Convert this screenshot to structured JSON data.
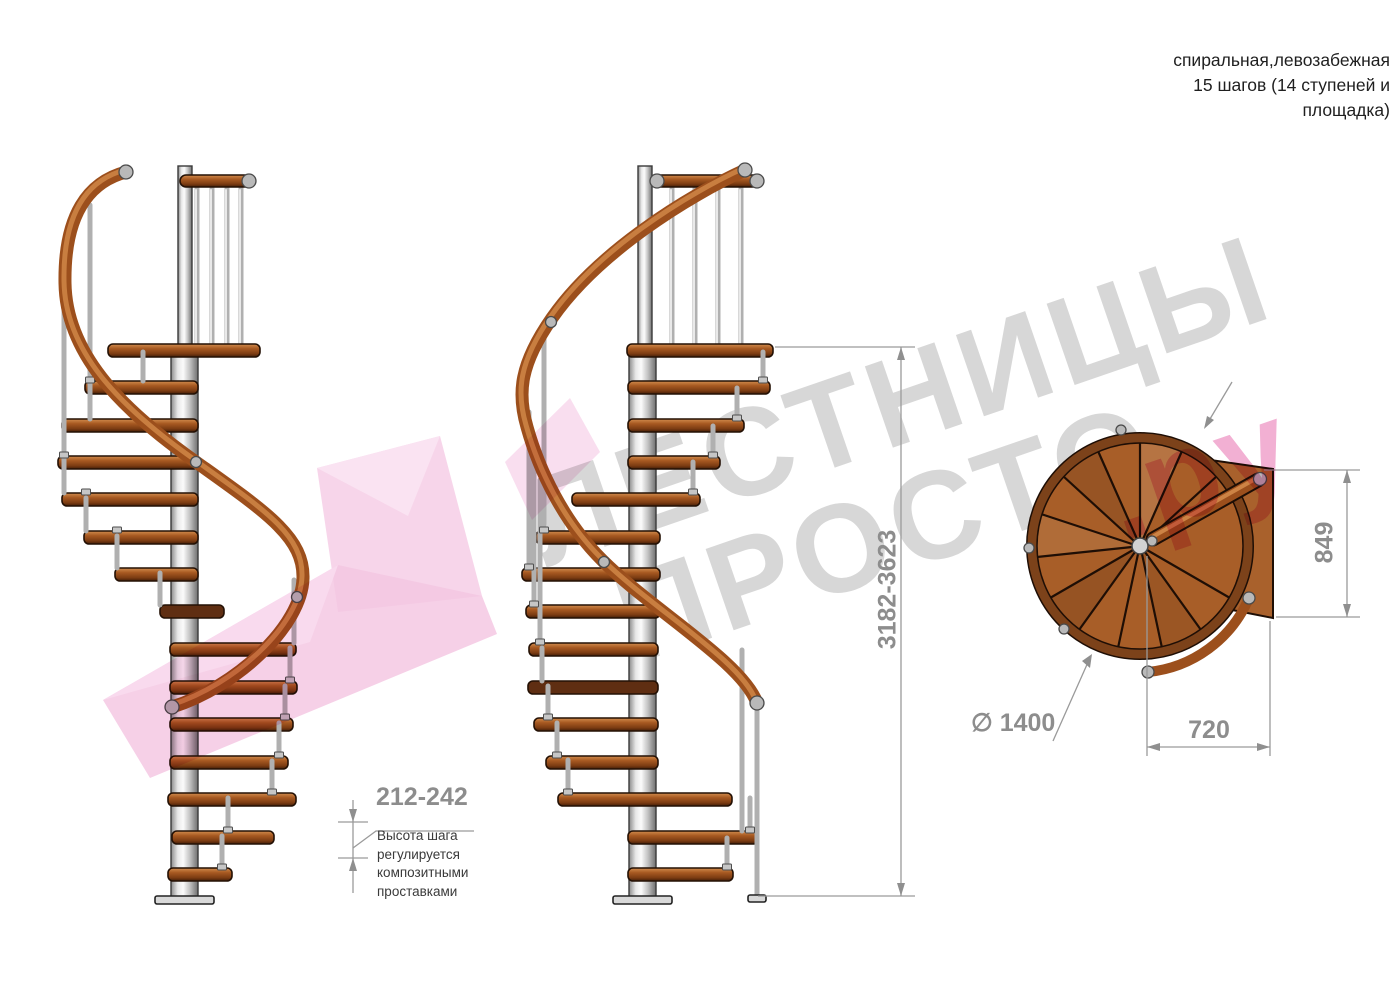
{
  "title": {
    "line1": "спиральная,левозабежная",
    "line2": "15 шагов (14 ступеней и",
    "line3": "площадка)"
  },
  "watermark": {
    "line1": "ЛЕСТНИЦЫ",
    "line2": "ПРОСТО",
    "suffix": ".ру",
    "gray_color": "#d7d7d7",
    "pink_color": "#f2b0d3",
    "ribbon_pink": "#f5cde7"
  },
  "dimensions": {
    "step_height": {
      "value": "212-242",
      "note": "Высота шага\nрегулируется\nкомпозитными\nпроставками"
    },
    "total_height": {
      "value": "3182-3623"
    },
    "landing_depth": {
      "value": "849"
    },
    "center_to_edge": {
      "value": "720"
    },
    "diameter": {
      "value": "∅ 1400"
    }
  },
  "colors": {
    "wood": "#a85e28",
    "wood_dark_edge": "#241105",
    "rim": "#7c421a",
    "handrail": "#9c4f1c",
    "pole_metal": "#c9c9c9",
    "dimension_gray": "#8f8f8f",
    "annotation_text": "#3a3a3a"
  }
}
